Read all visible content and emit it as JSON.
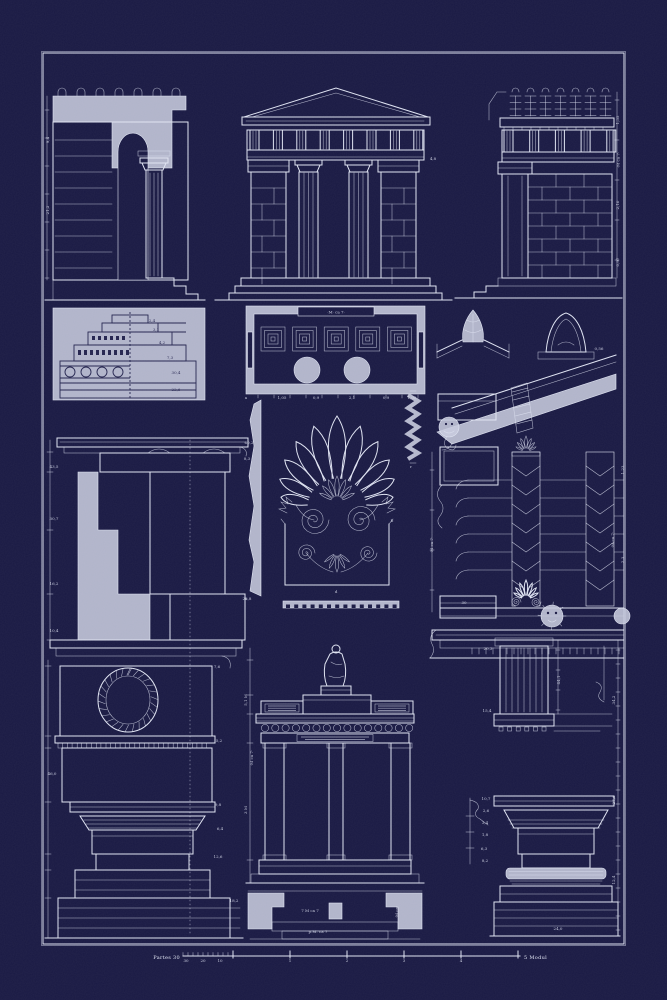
{
  "poster": {
    "title_hint": "blueprint plate of classical architecture details",
    "bg": "#191943",
    "line": "#dfe3f2",
    "fill": "#c6cadd",
    "dark": "#23234e"
  },
  "scale_bar": {
    "left_label": "Partes 30",
    "right_label": "5 Modul",
    "minor_labels": [
      "30",
      "20",
      "10"
    ],
    "major_labels": [
      "1",
      "2",
      "3",
      "4"
    ]
  },
  "annotations": [
    {
      "t": "·M· ca 7·",
      "x": 336,
      "y": 313.5,
      "s": 4.2,
      "r": 0
    },
    {
      "t": "·M ca 7·",
      "x": 619.5,
      "y": 160,
      "s": 3.8,
      "r": -90
    },
    {
      "t": "·M ca 7·",
      "x": 433,
      "y": 545,
      "s": 3.8,
      "r": -90
    },
    {
      "t": "·M ca 7·",
      "x": 614,
      "y": 540,
      "s": 3.8,
      "r": -90
    },
    {
      "t": "·M ca 7·",
      "x": 253,
      "y": 758,
      "s": 3.8,
      "r": -90
    },
    {
      "t": "7 M ca 7",
      "x": 310,
      "y": 912,
      "s": 3.8,
      "r": 0
    },
    {
      "t": "·M ca·",
      "x": 398,
      "y": 912,
      "s": 3.8,
      "r": -90
    },
    {
      "t": "p.M. ca 7",
      "x": 318,
      "y": 933,
      "s": 3.8,
      "r": 0
    }
  ],
  "dim_marks": [
    {
      "t": "9,4",
      "x": 49,
      "y": 140,
      "r": -90
    },
    {
      "t": "21,2",
      "x": 49,
      "y": 210,
      "r": -90
    },
    {
      "t": "4,8",
      "x": 433,
      "y": 160
    },
    {
      "t": "1,35",
      "x": 619,
      "y": 120,
      "r": -90
    },
    {
      "t": "2,10",
      "x": 619,
      "y": 205,
      "r": -90
    },
    {
      "t": "0,97",
      "x": 619,
      "y": 262,
      "r": -90
    },
    {
      "t": "2,4",
      "x": 152,
      "y": 322,
      "c": 1
    },
    {
      "t": "3,1",
      "x": 156,
      "y": 331,
      "c": 1
    },
    {
      "t": "4,2",
      "x": 162,
      "y": 344,
      "c": 1
    },
    {
      "t": "7,3",
      "x": 170,
      "y": 359,
      "c": 1
    },
    {
      "t": "30,4",
      "x": 176,
      "y": 374,
      "c": 1
    },
    {
      "t": "22,6",
      "x": 176,
      "y": 391,
      "c": 1
    },
    {
      "t": "1,05",
      "x": 282,
      "y": 399
    },
    {
      "t": "0,9",
      "x": 316,
      "y": 399
    },
    {
      "t": "2,1",
      "x": 352,
      "y": 399
    },
    {
      "t": "0,9",
      "x": 386,
      "y": 399
    },
    {
      "t": "1,05",
      "x": 412,
      "y": 399
    },
    {
      "t": "0,56",
      "x": 599,
      "y": 350
    },
    {
      "t": "43,5",
      "x": 54,
      "y": 468
    },
    {
      "t": "30,7",
      "x": 54,
      "y": 520
    },
    {
      "t": "16,2",
      "x": 54,
      "y": 585
    },
    {
      "t": "10,4",
      "x": 54,
      "y": 632
    },
    {
      "t": "60,2",
      "x": 249,
      "y": 444
    },
    {
      "t": "8,3",
      "x": 247,
      "y": 460
    },
    {
      "t": "25,8",
      "x": 247,
      "y": 600
    },
    {
      "t": "7,6",
      "x": 217,
      "y": 668
    },
    {
      "t": "5,2",
      "x": 219,
      "y": 742
    },
    {
      "t": "46,0",
      "x": 52,
      "y": 775
    },
    {
      "t": "9,8",
      "x": 218,
      "y": 806
    },
    {
      "t": "6,4",
      "x": 220,
      "y": 830
    },
    {
      "t": "12,6",
      "x": 218,
      "y": 858
    },
    {
      "t": "18,2",
      "x": 234,
      "y": 902
    },
    {
      "t": "a",
      "x": 246,
      "y": 399
    },
    {
      "t": "a",
      "x": 246,
      "y": 600
    },
    {
      "t": "b",
      "x": 392,
      "y": 522
    },
    {
      "t": "d",
      "x": 336,
      "y": 593
    },
    {
      "t": "r",
      "x": 411,
      "y": 468
    },
    {
      "t": "30",
      "x": 464,
      "y": 604
    },
    {
      "t": "1,23",
      "x": 624,
      "y": 470,
      "r": -90
    },
    {
      "t": "2,3",
      "x": 624,
      "y": 560,
      "r": -90
    },
    {
      "t": "5,1 M",
      "x": 247,
      "y": 700,
      "r": -90
    },
    {
      "t": "3 M",
      "x": 247,
      "y": 810,
      "r": -90
    },
    {
      "t": "20,3",
      "x": 488,
      "y": 650
    },
    {
      "t": "15,4",
      "x": 487,
      "y": 712
    },
    {
      "t": "10,7",
      "x": 486,
      "y": 800
    },
    {
      "t": "2,6",
      "x": 486,
      "y": 812
    },
    {
      "t": "3,4",
      "x": 485,
      "y": 824
    },
    {
      "t": "1,8",
      "x": 485,
      "y": 836
    },
    {
      "t": "6,3",
      "x": 484,
      "y": 850
    },
    {
      "t": "8,2",
      "x": 485,
      "y": 862
    },
    {
      "t": "34,2",
      "x": 615,
      "y": 700,
      "r": -90
    },
    {
      "t": "27,6",
      "x": 615,
      "y": 800,
      "r": -90
    },
    {
      "t": "12,4",
      "x": 615,
      "y": 880,
      "r": -90
    },
    {
      "t": "44,1",
      "x": 560,
      "y": 680,
      "r": -90
    },
    {
      "t": "24,0",
      "x": 558,
      "y": 930
    }
  ]
}
